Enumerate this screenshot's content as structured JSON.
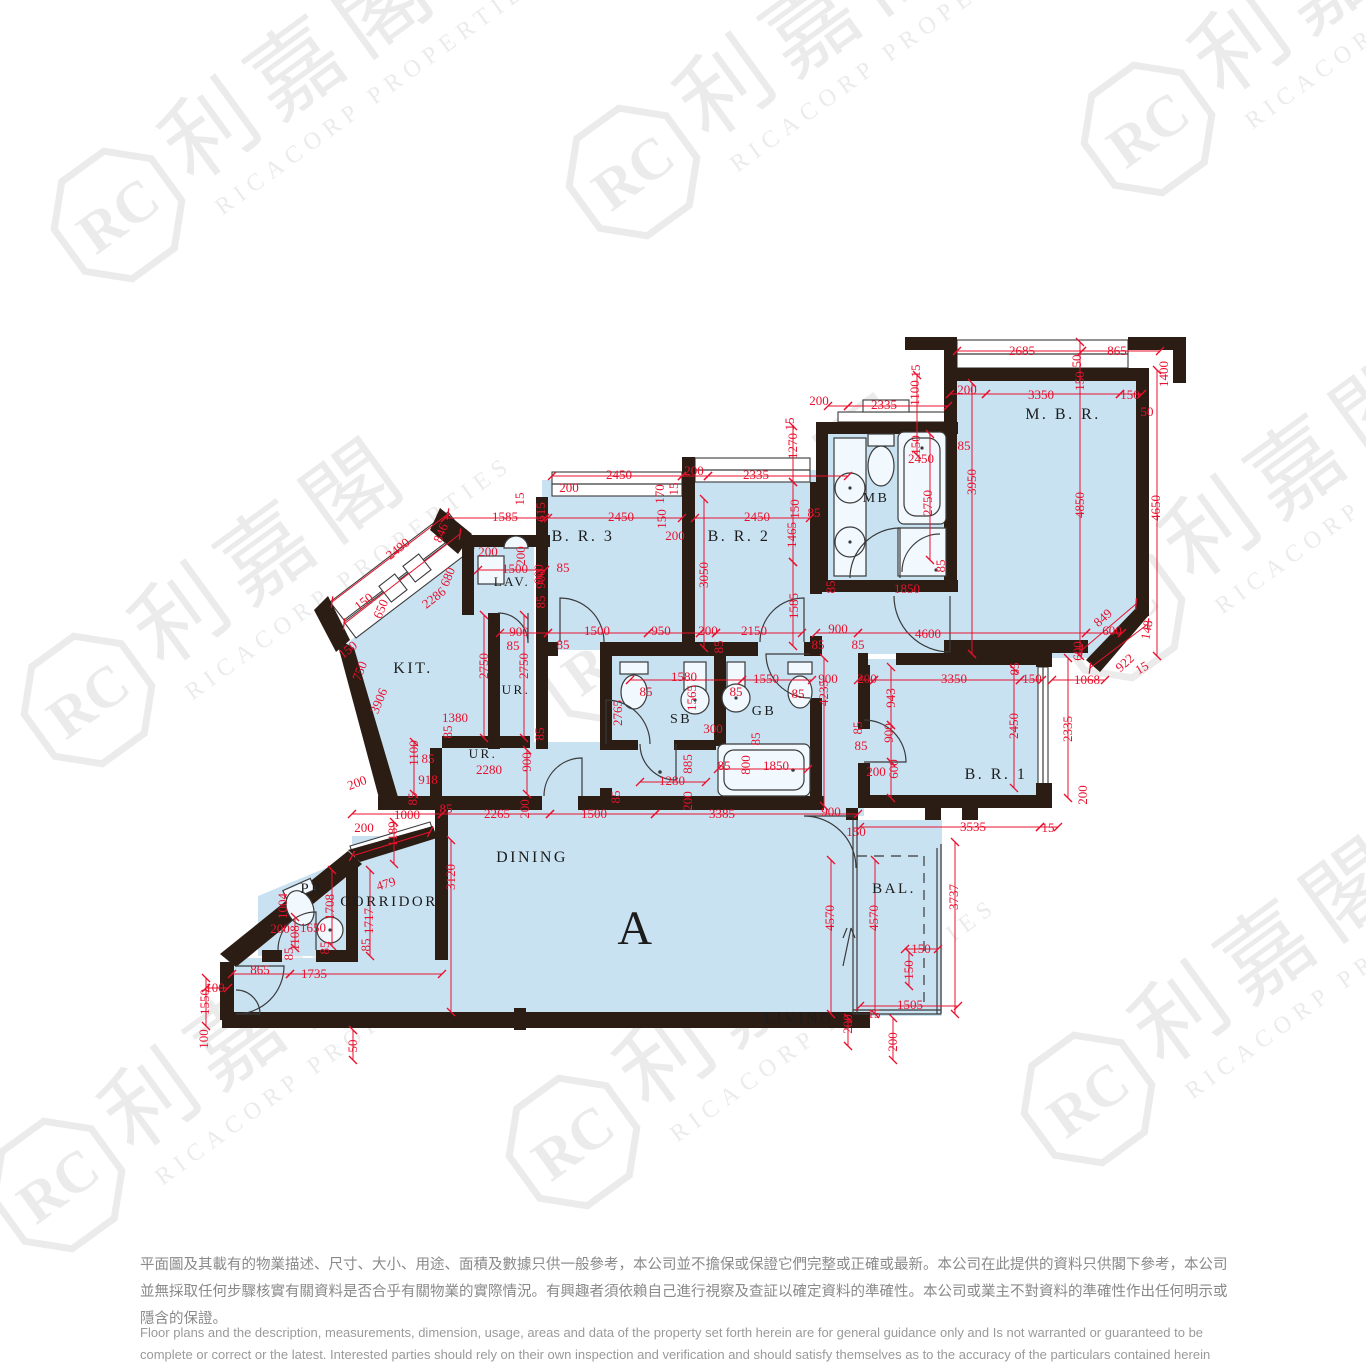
{
  "watermark": {
    "monogram": "RC",
    "cjk": "利嘉閣",
    "latin": "RICACORP PROPERTIES"
  },
  "colors": {
    "room_fill": "#c9e2f2",
    "wall": "#2b1d13",
    "dimension_red": "#e8112d"
  },
  "rooms": [
    {
      "t": "A",
      "x": 636,
      "y": 944,
      "s": 48
    },
    {
      "t": "DINING",
      "x": 532,
      "y": 862,
      "s": 16
    },
    {
      "t": "LIVING",
      "x": 799,
      "y": 1023,
      "s": 16
    },
    {
      "t": "BAL.",
      "x": 894,
      "y": 893,
      "s": 15
    },
    {
      "t": "CORRIDOR",
      "x": 389,
      "y": 906,
      "s": 15
    },
    {
      "t": "PR",
      "x": 312,
      "y": 893,
      "s": 15
    },
    {
      "t": "KIT.",
      "x": 413,
      "y": 673,
      "s": 16
    },
    {
      "t": "LAV.",
      "x": 512,
      "y": 586,
      "s": 13
    },
    {
      "t": "UR.",
      "x": 516,
      "y": 694,
      "s": 13
    },
    {
      "t": "UR.",
      "x": 483,
      "y": 758,
      "s": 13
    },
    {
      "t": "SB",
      "x": 681,
      "y": 723,
      "s": 14
    },
    {
      "t": "GB",
      "x": 764,
      "y": 715,
      "s": 14
    },
    {
      "t": "MB",
      "x": 876,
      "y": 502,
      "s": 14
    },
    {
      "t": "M. B. R.",
      "x": 1063,
      "y": 419,
      "s": 16
    },
    {
      "t": "B. R. 1",
      "x": 996,
      "y": 779,
      "s": 16
    },
    {
      "t": "B. R. 2",
      "x": 739,
      "y": 541,
      "s": 16
    },
    {
      "t": "B. R. 3",
      "x": 583,
      "y": 541,
      "s": 16
    }
  ],
  "dims": [
    [
      "2685",
      1022,
      351,
      0
    ],
    [
      "865",
      1117,
      351,
      0
    ],
    [
      "15",
      916,
      371,
      -90
    ],
    [
      "50",
      1077,
      361,
      -90
    ],
    [
      "1400",
      1164,
      374,
      -90
    ],
    [
      "1100",
      915,
      393,
      -90
    ],
    [
      "200",
      967,
      390,
      0
    ],
    [
      "3350",
      1041,
      395,
      0
    ],
    [
      "150",
      1080,
      381,
      -90
    ],
    [
      "150",
      1130,
      395,
      0
    ],
    [
      "50",
      1147,
      412,
      0
    ],
    [
      "85",
      964,
      446,
      0
    ],
    [
      "150",
      916,
      445,
      -90
    ],
    [
      "2450",
      921,
      459,
      0
    ],
    [
      "3950",
      972,
      482,
      -90
    ],
    [
      "2750",
      928,
      503,
      -90
    ],
    [
      "4850",
      1080,
      505,
      -90
    ],
    [
      "4650",
      1156,
      508,
      -90
    ],
    [
      "1850",
      907,
      589,
      0
    ],
    [
      "85",
      941,
      566,
      -90
    ],
    [
      "85",
      831,
      587,
      -90
    ],
    [
      "200",
      819,
      401,
      0
    ],
    [
      "2335",
      884,
      405,
      0
    ],
    [
      "15",
      790,
      424,
      -90
    ],
    [
      "1270",
      793,
      446,
      -90
    ],
    [
      "150",
      795,
      509,
      -90
    ],
    [
      "85",
      814,
      513,
      0
    ],
    [
      "1465",
      792,
      535,
      -90
    ],
    [
      "2450",
      619,
      475,
      0
    ],
    [
      "200",
      694,
      471,
      0
    ],
    [
      "2335",
      756,
      475,
      0
    ],
    [
      "200",
      569,
      488,
      0
    ],
    [
      "170",
      660,
      494,
      -90
    ],
    [
      "15",
      674,
      489,
      -90
    ],
    [
      "2450",
      621,
      517,
      0
    ],
    [
      "150",
      662,
      519,
      -90
    ],
    [
      "200",
      675,
      536,
      0
    ],
    [
      "2450",
      757,
      517,
      0
    ],
    [
      "3050",
      704,
      575,
      -90
    ],
    [
      "1585",
      794,
      606,
      -90
    ],
    [
      "900",
      539,
      574,
      -90
    ],
    [
      "85",
      541,
      602,
      -90
    ],
    [
      "85",
      563,
      568,
      0
    ],
    [
      "1500",
      597,
      631,
      0
    ],
    [
      "950",
      661,
      631,
      0
    ],
    [
      "200",
      708,
      631,
      0
    ],
    [
      "2150",
      754,
      631,
      0
    ],
    [
      "900",
      838,
      629,
      0
    ],
    [
      "85",
      563,
      645,
      0
    ],
    [
      "85",
      719,
      647,
      -90
    ],
    [
      "85",
      818,
      645,
      0
    ],
    [
      "4600",
      928,
      634,
      0
    ],
    [
      "85",
      858,
      645,
      0
    ],
    [
      "15",
      520,
      499,
      -90
    ],
    [
      "615",
      541,
      512,
      -90
    ],
    [
      "1585",
      505,
      517,
      0
    ],
    [
      "846",
      441,
      533,
      -68
    ],
    [
      "2490",
      398,
      549,
      -38
    ],
    [
      "200",
      488,
      552,
      0
    ],
    [
      "200",
      521,
      556,
      -90
    ],
    [
      "1500",
      515,
      569,
      0
    ],
    [
      "900",
      541,
      579,
      -90
    ],
    [
      "680",
      448,
      577,
      -68
    ],
    [
      "2286",
      434,
      598,
      -38
    ],
    [
      "150",
      364,
      602,
      -38
    ],
    [
      "900",
      519,
      632,
      0
    ],
    [
      "85",
      513,
      646,
      0
    ],
    [
      "650",
      381,
      609,
      -68
    ],
    [
      "150",
      348,
      650,
      -38
    ],
    [
      "750",
      360,
      671,
      -68
    ],
    [
      "3906",
      379,
      701,
      -68
    ],
    [
      "2750",
      484,
      666,
      -90
    ],
    [
      "2750",
      524,
      666,
      -90
    ],
    [
      "1380",
      455,
      718,
      0
    ],
    [
      "85",
      448,
      732,
      -90
    ],
    [
      "1100",
      414,
      753,
      -90
    ],
    [
      "85",
      428,
      759,
      0
    ],
    [
      "2280",
      489,
      770,
      0
    ],
    [
      "900",
      527,
      762,
      -90
    ],
    [
      "85",
      540,
      734,
      -90
    ],
    [
      "918",
      428,
      780,
      0
    ],
    [
      "200",
      357,
      783,
      -20
    ],
    [
      "85",
      413,
      799,
      -90
    ],
    [
      "200",
      364,
      828,
      0
    ],
    [
      "1000",
      407,
      815,
      0
    ],
    [
      "85",
      446,
      809,
      0
    ],
    [
      "2265",
      497,
      814,
      0
    ],
    [
      "200",
      525,
      809,
      -90
    ],
    [
      "1500",
      594,
      814,
      0
    ],
    [
      "3385",
      722,
      814,
      0
    ],
    [
      "900",
      831,
      812,
      0
    ],
    [
      "85",
      616,
      797,
      -90
    ],
    [
      "200",
      688,
      801,
      -90
    ],
    [
      "1580",
      684,
      677,
      0
    ],
    [
      "1550",
      766,
      679,
      0
    ],
    [
      "900",
      828,
      679,
      0
    ],
    [
      "85",
      646,
      692,
      0
    ],
    [
      "85",
      736,
      692,
      0
    ],
    [
      "85",
      798,
      694,
      0
    ],
    [
      "1565",
      692,
      698,
      -90
    ],
    [
      "2765",
      618,
      713,
      -90
    ],
    [
      "300",
      713,
      729,
      0
    ],
    [
      "85",
      756,
      739,
      -90
    ],
    [
      "885",
      688,
      764,
      -90
    ],
    [
      "85",
      724,
      766,
      0
    ],
    [
      "800",
      746,
      765,
      -90
    ],
    [
      "1850",
      776,
      766,
      0
    ],
    [
      "1280",
      672,
      781,
      0
    ],
    [
      "4235",
      824,
      693,
      -90
    ],
    [
      "200",
      867,
      679,
      0
    ],
    [
      "3350",
      954,
      679,
      0
    ],
    [
      "85",
      1015,
      669,
      -90
    ],
    [
      "150",
      1032,
      679,
      0
    ],
    [
      "1068",
      1087,
      680,
      0
    ],
    [
      "943",
      891,
      698,
      -90
    ],
    [
      "900",
      889,
      733,
      -90
    ],
    [
      "85",
      858,
      728,
      -90
    ],
    [
      "85",
      861,
      746,
      0
    ],
    [
      "2450",
      1014,
      726,
      -90
    ],
    [
      "2335",
      1068,
      729,
      -90
    ],
    [
      "200",
      876,
      772,
      0
    ],
    [
      "600",
      894,
      769,
      -90
    ],
    [
      "200",
      1083,
      795,
      -90
    ],
    [
      "600",
      1112,
      631,
      0
    ],
    [
      "600",
      1078,
      651,
      -90
    ],
    [
      "148",
      1147,
      630,
      -80
    ],
    [
      "849",
      1103,
      618,
      -42
    ],
    [
      "922",
      1125,
      663,
      -42
    ],
    [
      "15",
      1142,
      668,
      -30
    ],
    [
      "3535",
      973,
      827,
      0
    ],
    [
      "15",
      1048,
      828,
      0
    ],
    [
      "150",
      856,
      832,
      0
    ],
    [
      "1189",
      393,
      834,
      -90
    ],
    [
      "3120",
      451,
      877,
      -90
    ],
    [
      "479",
      386,
      884,
      -17
    ],
    [
      "1708",
      330,
      907,
      -90
    ],
    [
      "1717",
      369,
      921,
      -90
    ],
    [
      "1004",
      283,
      906,
      -90
    ],
    [
      "200",
      280,
      929,
      0
    ],
    [
      "1650",
      313,
      928,
      0
    ],
    [
      "1108",
      295,
      938,
      -90
    ],
    [
      "85",
      289,
      954,
      -90
    ],
    [
      "85",
      325,
      948,
      -90
    ],
    [
      "85",
      366,
      945,
      -90
    ],
    [
      "865",
      260,
      970,
      0
    ],
    [
      "1735",
      314,
      974,
      0
    ],
    [
      "100",
      215,
      988,
      0
    ],
    [
      "1550",
      205,
      1002,
      -90
    ],
    [
      "100",
      204,
      1039,
      -90
    ],
    [
      "50",
      353,
      1046,
      -90
    ],
    [
      "4570",
      830,
      918,
      -90
    ],
    [
      "4570",
      874,
      918,
      -90
    ],
    [
      "3737",
      954,
      897,
      -90
    ],
    [
      "150",
      921,
      949,
      0
    ],
    [
      "150",
      909,
      970,
      -90
    ],
    [
      "1505",
      910,
      1005,
      0
    ],
    [
      "15",
      874,
      1014,
      0
    ],
    [
      "200",
      848,
      1024,
      -90
    ],
    [
      "200",
      893,
      1042,
      -90
    ]
  ],
  "disclaimer": {
    "zh": "平面圖及其載有的物業描述、尺寸、大小、用途、面積及數據只供一般參考，本公司並不擔保或保證它們完整或正確或最新。本公司在此提供的資料只供閣下參考，本公司並無採取任何步驟核實有關資料是否合乎有關物業的實際情況。有興趣者須依賴自己進行視察及查証以確定資料的準確性。本公司或業主不對資料的準確性作出任何明示或隱含的保證。",
    "en": "Floor plans and the description, measurements, dimension, usage, areas and data of the property set forth herein are for general guidance only and Is not warranted or guaranteed to be complete or correct or the latest. Interested parties should rely on their own inspection and verification and should satisfy themselves as to the accuracy of the particulars contained herein which are provided by us for information only.  Our Company has not taken any step to verify whether the information reflects the actual status of the property.  No warranty for accuracy is given or implied by the owners or us."
  }
}
